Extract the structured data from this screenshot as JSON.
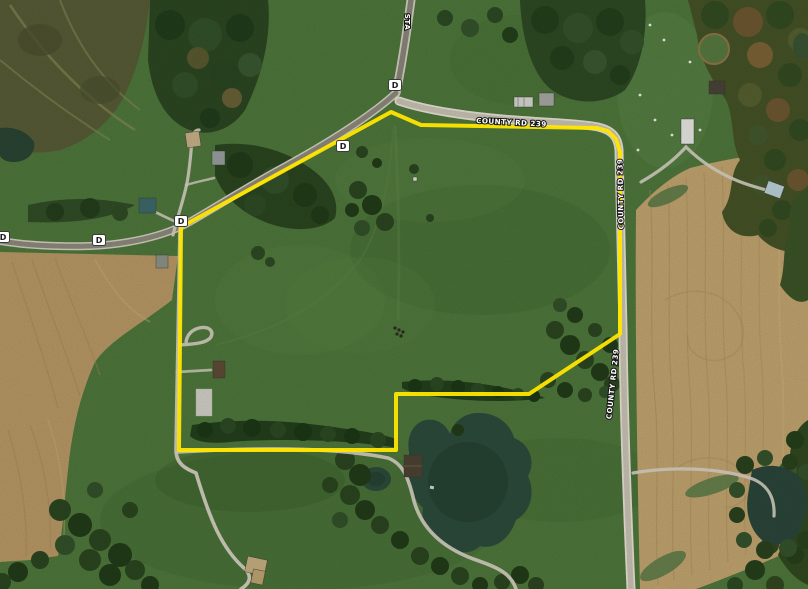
{
  "map": {
    "description": "Satellite aerial view of rural farmland parcel outlined in yellow",
    "road_labels": {
      "state_hwy_top": "STA",
      "county_rd_north": "COUNTY RD 239",
      "county_rd_east_upper": "COUNTY RD 239",
      "county_rd_east_lower": "COUNTY RD 239"
    },
    "route_shields": [
      {
        "id": "d-shield-left-edge",
        "label": "D"
      },
      {
        "id": "d-shield-left",
        "label": "D"
      },
      {
        "id": "d-shield-west-junction",
        "label": "D"
      },
      {
        "id": "d-shield-mid",
        "label": "D"
      },
      {
        "id": "d-shield-top-junction",
        "label": "D"
      }
    ],
    "boundary": {
      "color": "#ffe600",
      "description": "yellow property boundary outline"
    },
    "colors": {
      "pasture_green": "#50783d",
      "forest_green": "#2c4a23",
      "cropland_tan": "#c0a26c",
      "water_dark": "#2d4c3c",
      "road_light": "#cfc9ba",
      "road_dark": "#8f8a7d",
      "boundary_yellow": "#ffe600"
    }
  }
}
